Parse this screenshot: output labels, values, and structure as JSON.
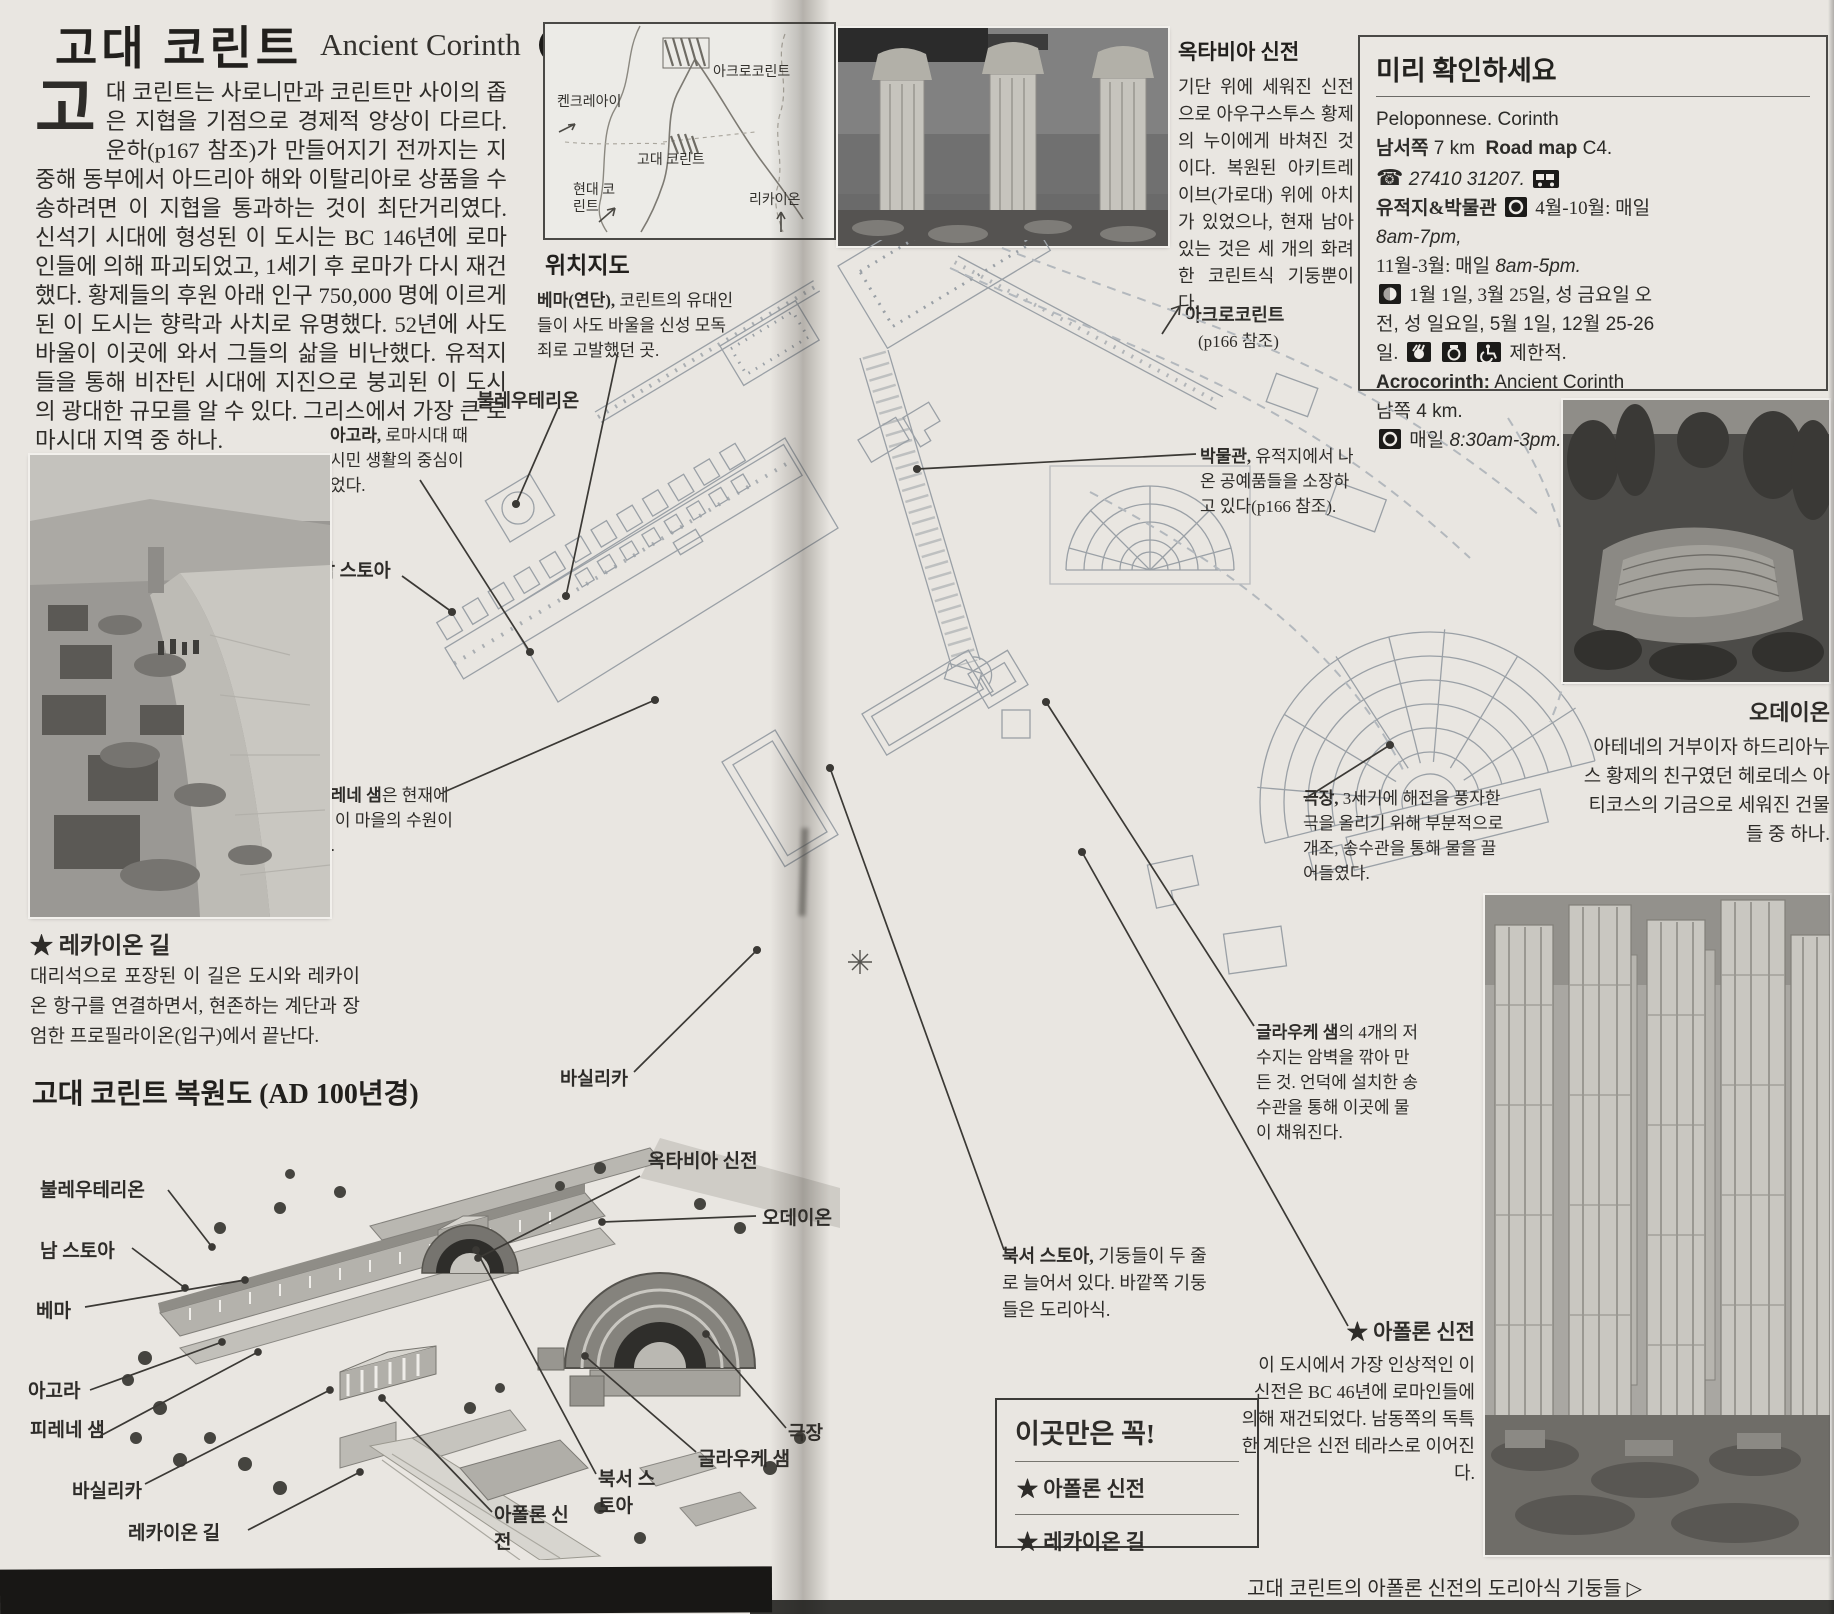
{
  "header": {
    "title_ko": "고대 코린트",
    "title_en": "Ancient Corinth",
    "badge": "1"
  },
  "intro": {
    "dropcap": "고",
    "text": "대 코린트는 사로니만과 코린트만 사이의 좁은 지협을 기점으로 경제적 양상이 다르다. 운하(p167 참조)가 만들어지기 전까지는 지중해 동부에서 아드리아 해와 이탈리아로 상품을 수송하려면 이 지협을 통과하는 것이 최단거리였다. 신석기 시대에 형성된 이 도시는 BC 146년에 로마인들에 의해 파괴되었고, 1세기 후 로마가 다시 재건했다. 황제들의 후원 아래 인구 750,000 명에 이르게 된 이 도시는 향락과 사치로 유명했다. 52년에 사도 바울이 이곳에 와서 그들의 삶을 비난했다. 유적지들을 통해 비잔틴 시대에 지진으로 붕괴된 이 도시의 광대한 규모를 알 수 있다. 그리스에서 가장 큰 로마시대 지역 중 하나."
  },
  "location_map": {
    "caption": "위치지도",
    "labels": {
      "kenchreai": "켄크레아이",
      "acrocorinth": "아크로코린트",
      "ancient": "고대 코린트",
      "modern": "현대 코린트",
      "lechaion_town": "리카이온"
    }
  },
  "octavia": {
    "title": "옥타비아 신전",
    "body": "기단 위에 세워진 신전으로 아우구스투스 황제의 누이에게 바쳐진 것이다. 복원된 아키트레이브(가로대) 위에 아치가 있었으나, 현재 남아 있는 것은 세 개의 화려한 코린트식 기둥뿐이다."
  },
  "checklist": {
    "title": "미리 확인하세요",
    "region": "Peloponnese. Corinth",
    "direction": "남서쪽",
    "distance": "7 km",
    "roadmap_label": "Road map",
    "roadmap_value": "C4.",
    "phone_icon": "☎",
    "phone": "27410 31207.",
    "site_label": "유적지&박물관",
    "hours_a": "4월-10월: 매일",
    "hours_a_time": "8am-7pm,",
    "hours_b": "11월-3월: 매일",
    "hours_b_time": "8am-5pm.",
    "closed_a": "1월 1일, 3월 25일, 성 금요일 오",
    "closed_b": "전, 성 일요일, 5월 1일, 12월 25-26",
    "closed_c": "일.",
    "limited": "제한적.",
    "acro_name": "Acrocorinth:",
    "acro_rest": "Ancient Corinth",
    "acro_dist": "남쪽 4 km.",
    "acro_open": "매일",
    "acro_time": "8:30am-3pm."
  },
  "plan_callouts": {
    "bouleuterion": "불레우테리온",
    "agora_bold": "아고라,",
    "agora_rest": " 로마시대 때 시민 생활의 중심이 었다.",
    "south_stoa": "남 스토아",
    "bema_bold": "베마(연단),",
    "bema_rest": " 코린트의 유대인들이 사도 바울을 신성 모독죄로 고발했던 곳.",
    "peirene_bold": "피레네 샘",
    "peirene_rest": "은 현재에도 이 마을의 수원이다.",
    "basilica": "바실리카",
    "acro_line1": "아크로코린트",
    "acro_line2": "(p166 참조)",
    "museum_bold": "박물관,",
    "museum_rest": " 유적지에서 나온 공예품들을 소장하고 있다(p166 참조).",
    "glauke_bold": "글라우케 샘",
    "glauke_rest": "의 4개의 저수지는 암벽을 깎아 만든 것. 언덕에 설치한 송수관을 통해 이곳에 물이 채워진다.",
    "theatre_bold": "극장,",
    "theatre_rest": " 3세기에 해전을 풍자한 극을 올리기 위해 부분적으로 개조, 송수관을 통해 물을 끌어들였다.",
    "nw_stoa_bold": "북서 스토아,",
    "nw_stoa_rest": " 기둥들이 두 줄로 늘어서 있다. 바깥쪽 기둥들은 도리아식."
  },
  "lechaion_way": {
    "title": "★ 레카이온 길",
    "body": "대리석으로 포장된 이 길은 도시와 레카이온 항구를 연결하면서, 현존하는 계단과 장엄한 프로필라이온(입구)에서 끝난다."
  },
  "odeion": {
    "title": "오데이온",
    "body": "아테네의 거부이자 하드리아누스 황제의 친구였던 헤로데스 아티코스의 기금으로 세워진 건물들 중 하나."
  },
  "reconstruction": {
    "title": "고대 코린트 복원도 (AD 100년경)",
    "labels": {
      "bouleuterion": "불레우테리온",
      "south_stoa": "남 스토아",
      "bema": "베마",
      "agora": "아고라",
      "peirene": "피레네 샘",
      "basilica": "바실리카",
      "lechaion_way": "레카이온 길",
      "octavia": "옥타비아 신전",
      "odeion": "오데이온",
      "glauke": "글라우케 샘",
      "theatre": "극장",
      "nw_stoa": "북서 스토아",
      "apollo": "아폴론 신전"
    }
  },
  "apollo_temple": {
    "title": "★ 아폴론 신전",
    "body": "이 도시에서 가장 인상적인 이 신전은 BC 46년에 로마인들에 의해 재건되었다. 남동쪽의 독특한 계단은 신전 테라스로 이어진다."
  },
  "must_see": {
    "title": "이곳만은 꼭!",
    "item1": "★ 아폴론 신전",
    "item2": "★ 레카이온 길"
  },
  "footer_caption": "고대 코린트의 아폴론 신전의 도리아식 기둥들 ▷"
}
